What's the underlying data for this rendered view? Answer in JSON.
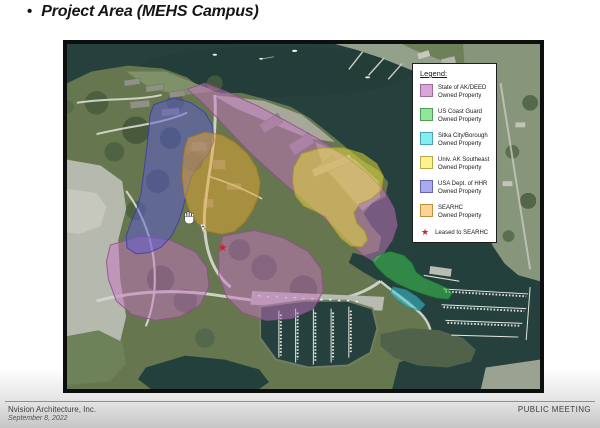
{
  "slide": {
    "title_bullet": "•",
    "title": "Project Area (MEHS Campus)"
  },
  "legend": {
    "heading": "Legend:",
    "items": [
      {
        "line1": "State of AK/DEED",
        "line2": "Owned Property",
        "color": "#d9a7d6",
        "border": "#a06ba0"
      },
      {
        "line1": "US Coast Guard",
        "line2": "Owned Property",
        "color": "#90e696",
        "border": "#4f9e57"
      },
      {
        "line1": "Sitka City/Borough",
        "line2": "Owned Property",
        "color": "#83eef2",
        "border": "#46a7ae"
      },
      {
        "line1": "Univ. AK Southeast",
        "line2": "Owned Property",
        "color": "#fbf38b",
        "border": "#b5ab47"
      },
      {
        "line1": "USA Dept. of HHR",
        "line2": "Owned Property",
        "color": "#a9a9ec",
        "border": "#6565b8"
      },
      {
        "line1": "SEARHC",
        "line2": "Owned Property",
        "color": "#f8d495",
        "border": "#c08f40"
      }
    ],
    "star": {
      "symbol": "★",
      "label": "Leased to SEARHC",
      "color": "#cc2626"
    }
  },
  "map": {
    "water_color": "#26413d",
    "overlay_colors": {
      "deed": "#c873c4",
      "coast_guard": "#3ecf52",
      "city_borough": "#3ccfe2",
      "university": "#ece239",
      "hhr": "#5c5cd8",
      "searhc": "#e8a832"
    },
    "annotations": {
      "star_symbol": "★",
      "cursor": "hand"
    }
  },
  "footer": {
    "company": "Nvision Architecture, Inc.",
    "date": "September 8, 2022",
    "right": "PUBLIC MEETING"
  }
}
